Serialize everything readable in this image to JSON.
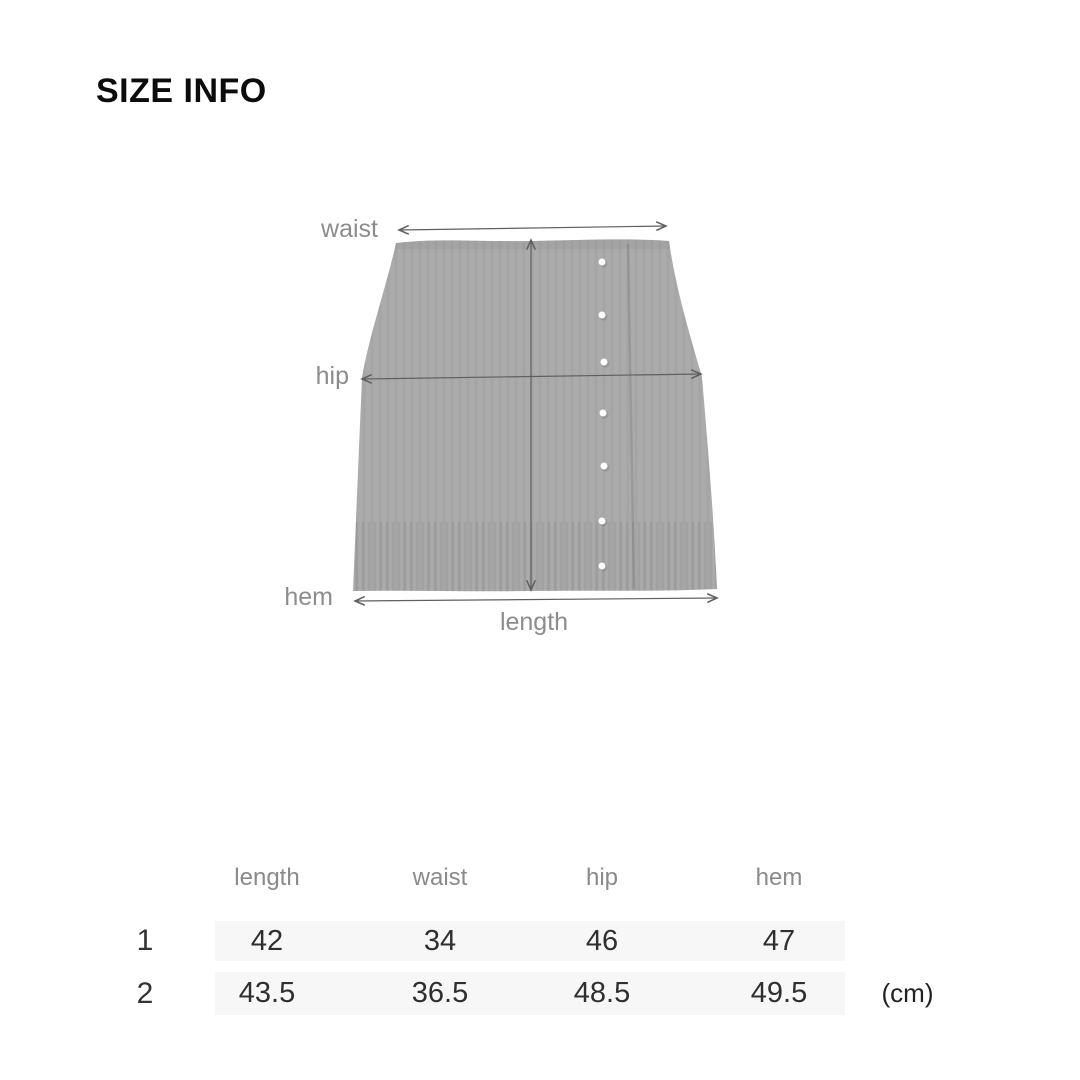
{
  "page": {
    "title": "SIZE INFO"
  },
  "diagram": {
    "labels": {
      "waist": "waist",
      "hip": "hip",
      "hem": "hem",
      "length": "length"
    },
    "colors": {
      "garment_fill": "#ababab",
      "measure_line": "#5f5f5f",
      "label_text": "#8c8c8c",
      "button_dot": "#fdfdfd"
    }
  },
  "size_table": {
    "columns": [
      "length",
      "waist",
      "hip",
      "hem"
    ],
    "rows": [
      {
        "label": "1",
        "values": [
          "42",
          "34",
          "46",
          "47"
        ]
      },
      {
        "label": "2",
        "values": [
          "43.5",
          "36.5",
          "48.5",
          "49.5"
        ]
      }
    ],
    "unit": "(cm)",
    "stripe_color": "#f7f7f7",
    "header_text": "#8a8a8a",
    "value_text": "#2f2f2f"
  }
}
